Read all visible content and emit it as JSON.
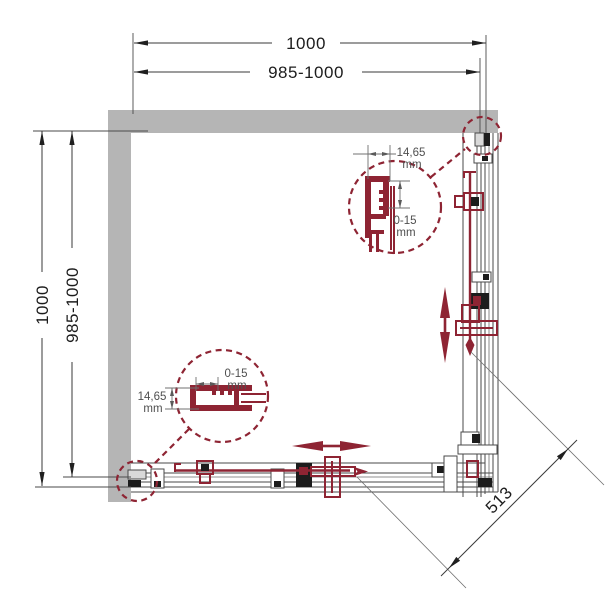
{
  "diagram": {
    "dim_top_outer": "1000",
    "dim_top_inner": "985-1000",
    "dim_left_outer": "1000",
    "dim_left_inner": "985-1000",
    "dim_diagonal": "513",
    "detail_top_right": {
      "width": "14,65",
      "width_unit": "mm",
      "range": "0-15",
      "range_unit": "mm"
    },
    "detail_bottom_left": {
      "range": "0-15",
      "range_unit": "mm",
      "width": "14,65",
      "width_unit": "mm"
    },
    "colors": {
      "accent": "#8e2433",
      "wall": "#b5b5b5",
      "line": "#4a4a4a"
    }
  }
}
